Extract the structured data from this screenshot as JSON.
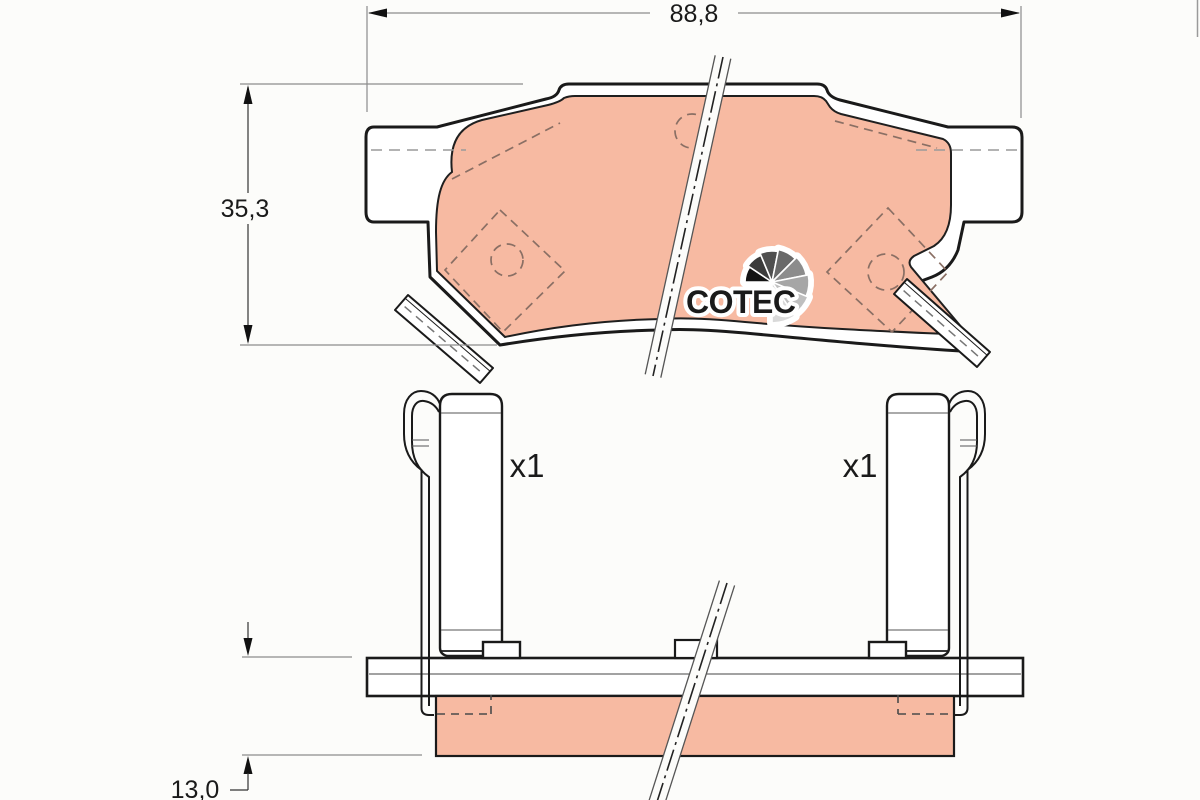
{
  "drawing": {
    "type": "brake-pad-technical-drawing",
    "logo_text": "COTEC",
    "dimensions": {
      "width_label": "88,8",
      "height_label": "35,3",
      "thickness_label": "13,0"
    },
    "quantities": {
      "left_clip": "x1",
      "right_clip": "x1"
    }
  },
  "colors": {
    "background": "#fcfcfa",
    "outline": "#1a1a1a",
    "dim_line": "#8c8c8c",
    "friction_material": "#f7baa2",
    "dash_on_friction": "#8a6f64",
    "dash_gray": "#9a9a9a",
    "logo_text": "#161616",
    "logo_wedges": [
      "#141414",
      "#3b3b3b",
      "#4f4f4f",
      "#696969",
      "#8c8c8c",
      "#a6a6a6",
      "#bfbfbf",
      "#d9d9d9"
    ]
  }
}
